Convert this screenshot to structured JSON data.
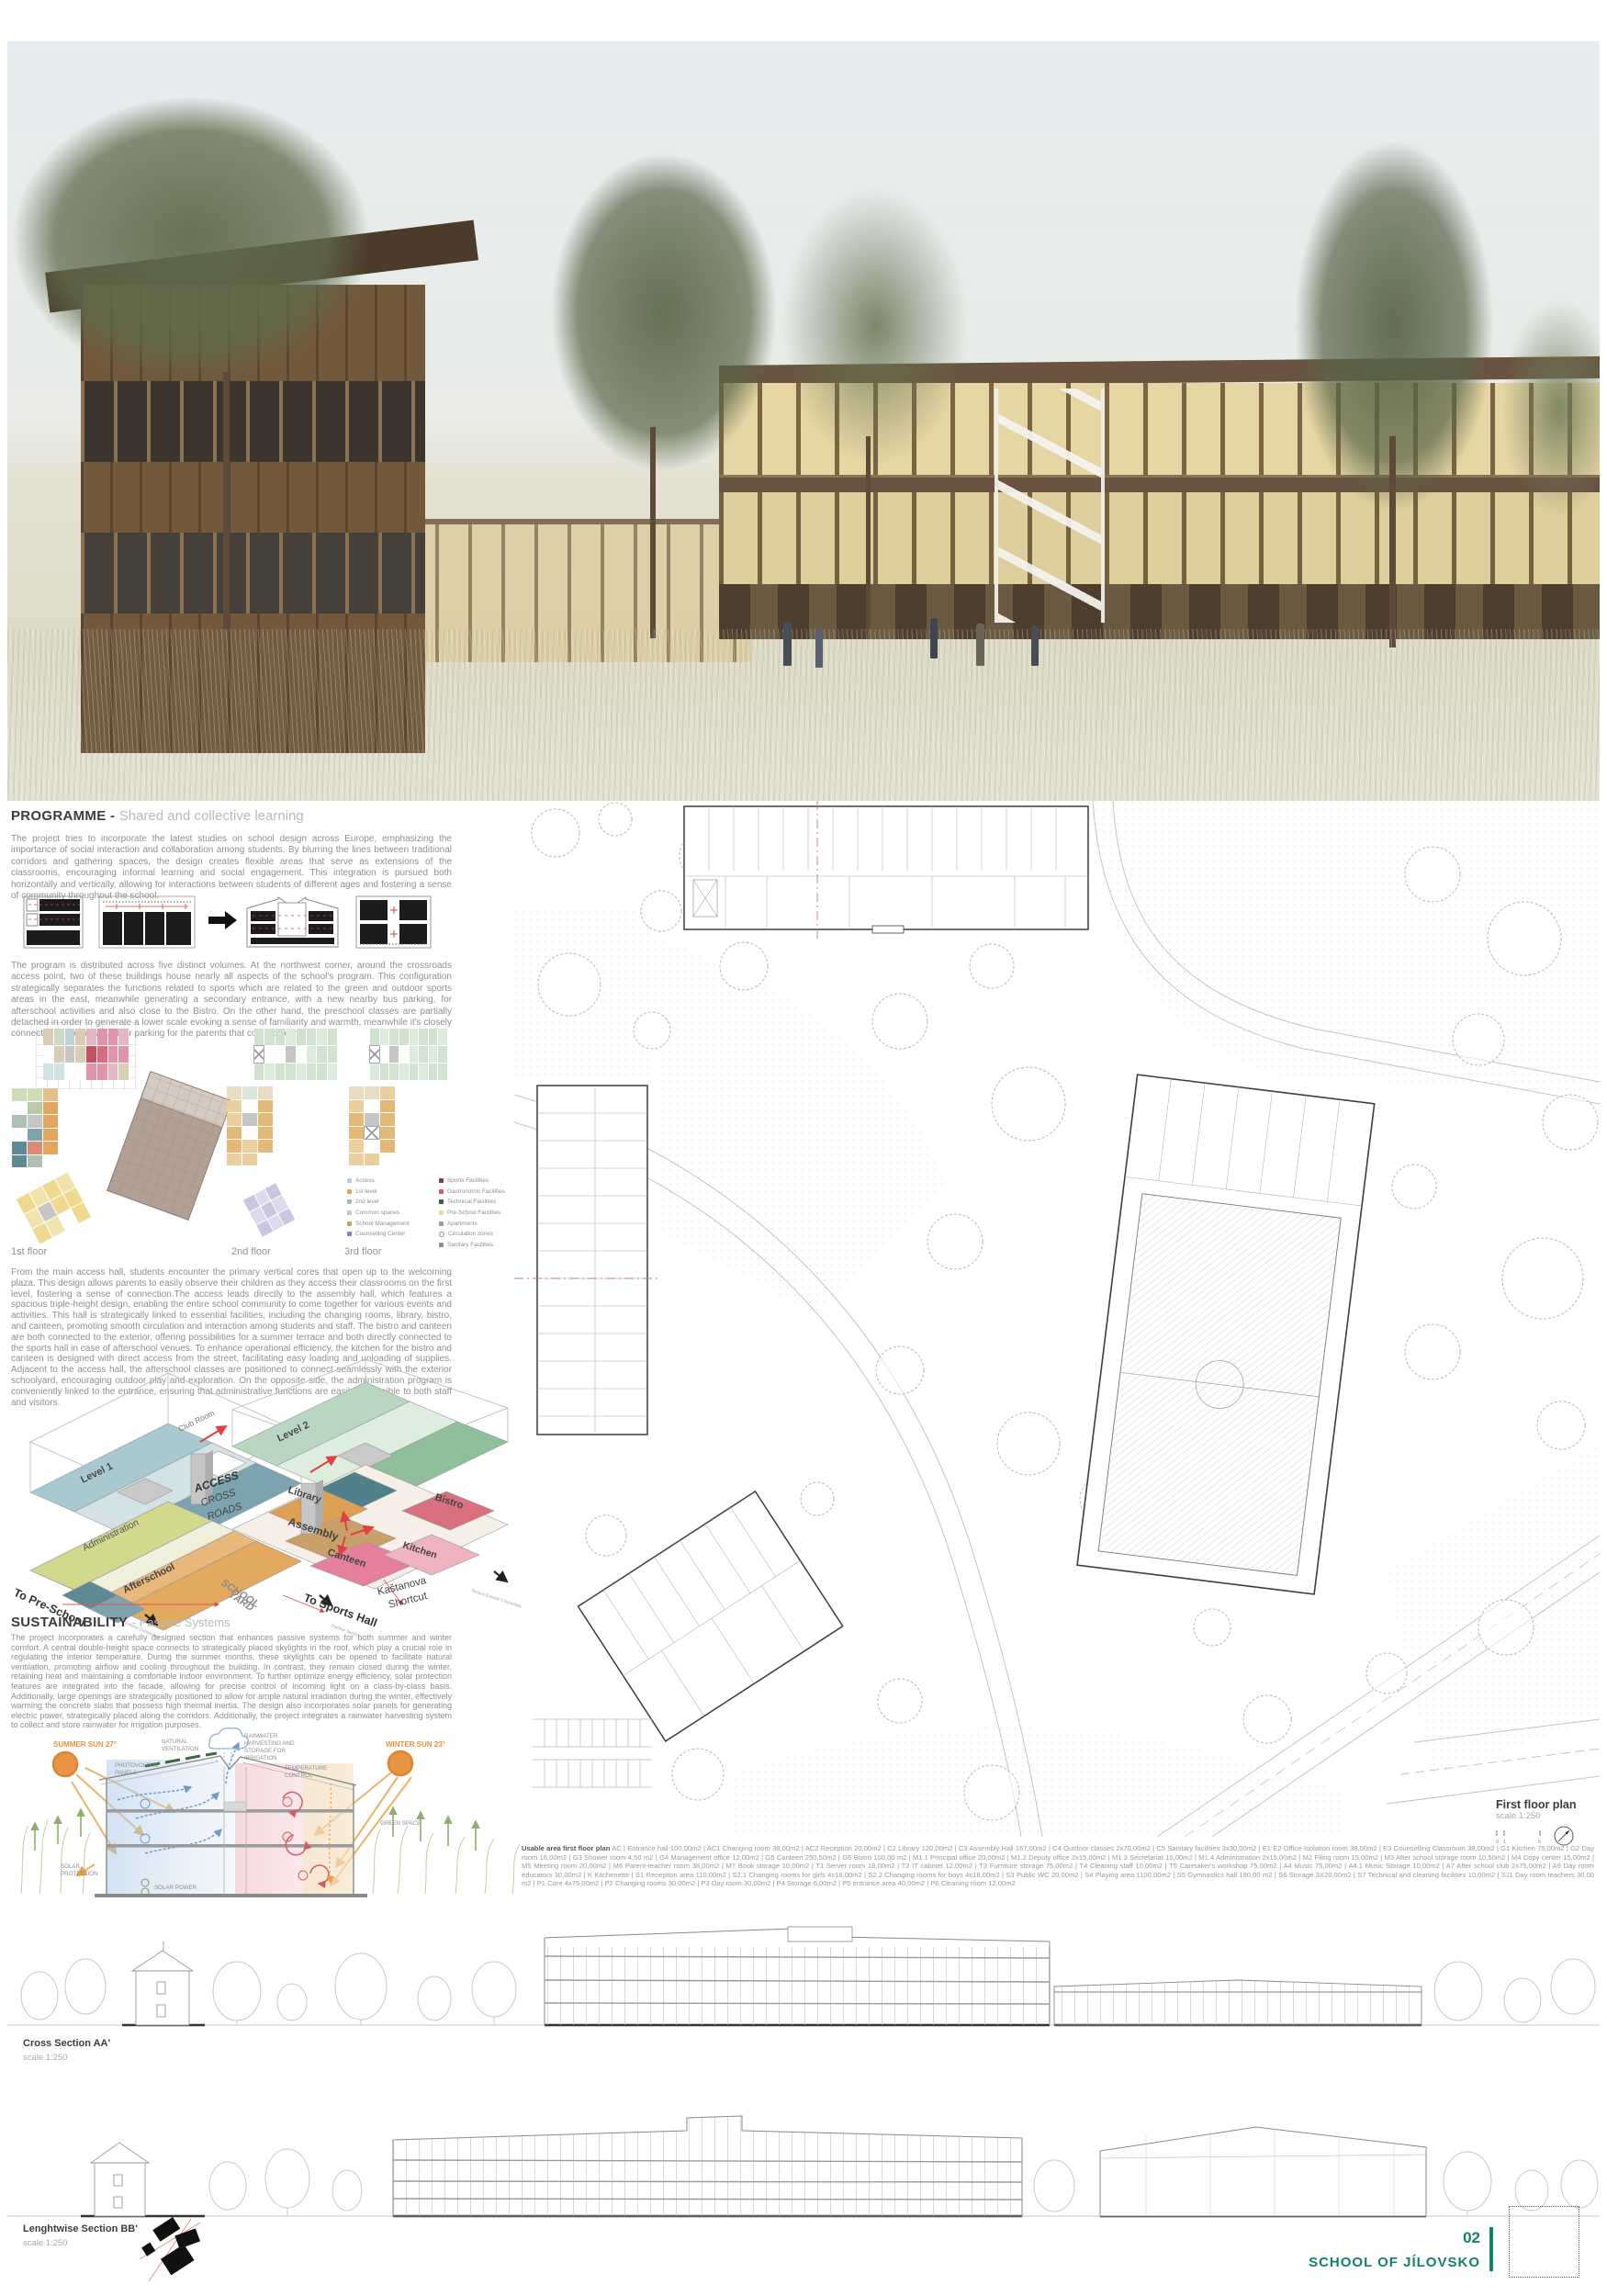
{
  "board": {
    "page_number": "02",
    "project_title": "SCHOOL OF JÍLOVSKO",
    "accent_green": "#12836a"
  },
  "programme": {
    "heading": "PROGRAMME -",
    "subheading": "Shared and collective learning",
    "para1": "The project tries to incorporate the latest studies on school design across Europe, emphasizing the importance of social interaction and collaboration among students. By blurring the lines between traditional corridors and gathering spaces, the design creates flexible areas that serve as extensions of the classrooms, encouraging informal learning and social engagement. This integration is pursued both horizontally and vertically, allowing for interactions between students of different ages and fostering a sense of community throughout the school.",
    "para2": "The program is distributed across five distinct volumes. At the northwest corner, around the crossroads access point, two of these buildings house nearly all aspects of the school's program. This configuration strategically separates the functions related to sports which are related to the green and outdoor sports areas in the east, meanwhile generating a secondary entrance, with a new nearby bus parking, for afterschool activities and also close to the Bistro. On the other hand, the preschool classes are partially detached in order to generate a lower scale evoking a sense of familiarity and warmth, meanwhile it's closely connected to the new outdoor parking for the parents that come by car.",
    "para3": "From the main access hall, students encounter the primary vertical cores that open up to the welcoming plaza. This design allows parents to easily observe their children as they access their classrooms on the first level, fostering a sense of connection.The access leads directly to the assembly hall, which features a spacious triple-height design, enabling the entire school community to come together for various events and activities. This hall is strategically linked to essential facilities, including the changing rooms, library, bistro, and canteen, promoting smooth circulation and interaction among students and staff. The bistro and canteen are both connected to the exterior, offering possibilities for a summer terrace and both directly connected to the sports hall in case of afterschool venues. To enhance operational efficiency, the kitchen for the bistro and canteen is designed with direct access from the street, facilitating easy loading and unloading of supplies. Adjacent to the access hall, the afterschool classes are positioned to connect seamlessly with the exterior schoolyard, encouraging outdoor play and exploration. On the opposite side, the administration program is conveniently linked to the entrance, ensuring that administrative functions are easily accessible to both staff and visitors.",
    "floor_labels": [
      "1st floor",
      "2nd floor",
      "3rd floor"
    ],
    "legend_left": [
      {
        "label": "Access",
        "color": "#b9c7e6"
      },
      {
        "label": "1st level",
        "color": "#dca45c"
      },
      {
        "label": "2nd level",
        "color": "#a9bca9"
      },
      {
        "label": "Common spaces",
        "color": "#c6c6c6"
      },
      {
        "label": "School Management",
        "color": "#b1b054"
      },
      {
        "label": "Counselling Center",
        "color": "#6d8cc0"
      }
    ],
    "legend_right": [
      {
        "label": "Sports Facilities",
        "color": "#8e3544"
      },
      {
        "label": "Gastronomic Facilities",
        "color": "#cf5f5f"
      },
      {
        "label": "Technical Facilities",
        "color": "#2f5f4f"
      },
      {
        "label": "Pre-School Facilities",
        "color": "#eeda90"
      },
      {
        "label": "Apartments",
        "color": "#9d9d9d"
      },
      {
        "label": "Circulation zones",
        "color": "#ffffff"
      },
      {
        "label": "Sanitary Facilities",
        "color": "#8f8f8f"
      }
    ]
  },
  "axon": {
    "level1": "Level 1",
    "level2": "Level 2",
    "club_room": "Club Room",
    "access_line1": "ACCESS",
    "access_line2": "CROSS",
    "access_line3": "ROADS",
    "administration": "Administration",
    "afterschool": "Afterschool",
    "library": "Library",
    "assembly": "Assembly",
    "bistro": "Bistro",
    "canteen": "Canteen",
    "kitchen": "Kitchen",
    "to_preschool": "To Pre-School",
    "school_yard_line1": "SCHOOL",
    "school_yard_line2": "YARD",
    "to_sports_hall": "To Sports Hall",
    "kastanova_line1": "Kaštanova",
    "kastanova_line2": "Shortcut",
    "exterior_connection": "Exterior Connection",
    "outdoor_sports": "Outdoor Sports",
    "terrace_connection": "Terrace Exterior Connection"
  },
  "sustainability": {
    "heading": "SUSTAINABILITY",
    "subheading": "- Passive Systems",
    "para": "The project incorporates a carefully designed section that enhances passive systems for both summer and winter comfort. A central double-height space connects to strategically placed skylights in the roof, which play a crucial role in regulating the interior temperature. During the summer months, these skylights can be opened to facilitate natural ventilation, promoting airflow and cooling throughout the building. In contrast, they remain closed during the winter, retaining heat and maintaining a comfortable indoor environment. To further optimize energy efficiency, solar protection features are integrated into the facade, allowing for precise control of incoming light on a class-by-class basis. Additionally, large openings are strategically positioned to allow for ample natural irradiation during the winter, effectively warming the concrete slabs that possess high thermal inertia. The design also incorporates solar panels for generating electric power, strategically placed along the corridors. Additionally, the project integrates a rainwater harvesting system to collect and store rainwater for irrigation purposes.",
    "summer_sun": "SUMMER SUN 27°",
    "winter_sun": "WINTER SUN 23°",
    "natural_ventilation_1": "NATURAL",
    "natural_ventilation_2": "VENTILATION",
    "photovoltaic_1": "PHOTOVOLTAIC",
    "photovoltaic_2": "PANELS",
    "rainwater_1": "RAINWATER",
    "rainwater_2": "HARVESTING AND",
    "rainwater_3": "STORAGE FOR",
    "rainwater_4": "IRRIGATION",
    "temperature_1": "TEMPERATURE",
    "temperature_2": "CONTROL",
    "green_space": "GREEN SPACE",
    "solar_protection_1": "SOLAR",
    "solar_protection_2": "PROTECTION",
    "solar_power": "SOLAR POWER"
  },
  "site_plan": {
    "title": "First floor plan",
    "scale": "scale 1:250",
    "tick0": "0",
    "tick1": "1",
    "tick5": "5"
  },
  "usable_area": {
    "label": "Usable area first floor plan",
    "text": "AC | Entrance hall 100,00m2 | AC1 Changing room 38,00m2 | AC2 Reception 20,00m2 | C2 Library 120,00m2 | C3 Assembly Hall 167,00m2 | C4 Outdoor classes 2x70,00m2 | C5 Sanitary facilities 3x30,00m2 | E1 E2 Office-Isolation room 38,00m2 | E3 Counselling Classroom 38,00m2 | G1 Kitchen 75,00m2 | G2 Day room 16,00m2 | G3 Shower room 4,50 m2 | G4 Management office 12,00m2 | G5 Canteen 250,50m2 | G6 Bistro 100,00 m2 | M1.1 Principal office 20,00m2 | M1.2 Deputy office 2x15,00m2 | M1.3 Secretariat 15,00m2 | M1.4 Administration 2x15,00m2 | M2 Filing room 15,00m2 | M3 After school storage room 10,50m2 | M4 Copy center 15,00m2 | M5 Meeting room 20,00m2 | M6 Parent-teacher room 38,00m2 | M7 Book storage 10,00m2 | T1 Server room 18,00m2 | T2 IT cabinet 12,00m2 | T3 Furniture storage 75,00m2 | T4 Cleaning staff 10,00m2 | T5 Caretaker's workshop 75,00m2 | A4 Music 75,00m2 | A4.1 Music Storage 10,00m2 | A7 After school club 2x75,00m2 | A9 Day room educators 30,00m2 | K Kitchenette | S1 Reception area 110,00m2 | S2.1 Changing rooms for girls 4x18,00m2 | S2.2 Changing rooms for boys 4x18,00m2 | S3 Public WC 20,00m2 | S4 Playing area 1100,00m2 | S5 Gymnastics hall 180,00 m2 | S6 Storage 3X20,00m2 | S7 Technical and cleaning facilities 10,00m2 | S11 Day room teachers 30,00 m2 | P1 Core 4x75,00m2 | P2 Changing rooms 30,00m2 | P3 Day room 30,00m2 | P4 Storage 6,00m2 | P5 entrance area 40,00m2 | P6 Cleaning room 12,00m2"
  },
  "sections": {
    "cross_title": "Cross Section AA'",
    "cross_scale": "scale 1:250",
    "lengthwise_title": "Lenghtwise Section BB'",
    "lengthwise_scale": "scale 1:250"
  }
}
